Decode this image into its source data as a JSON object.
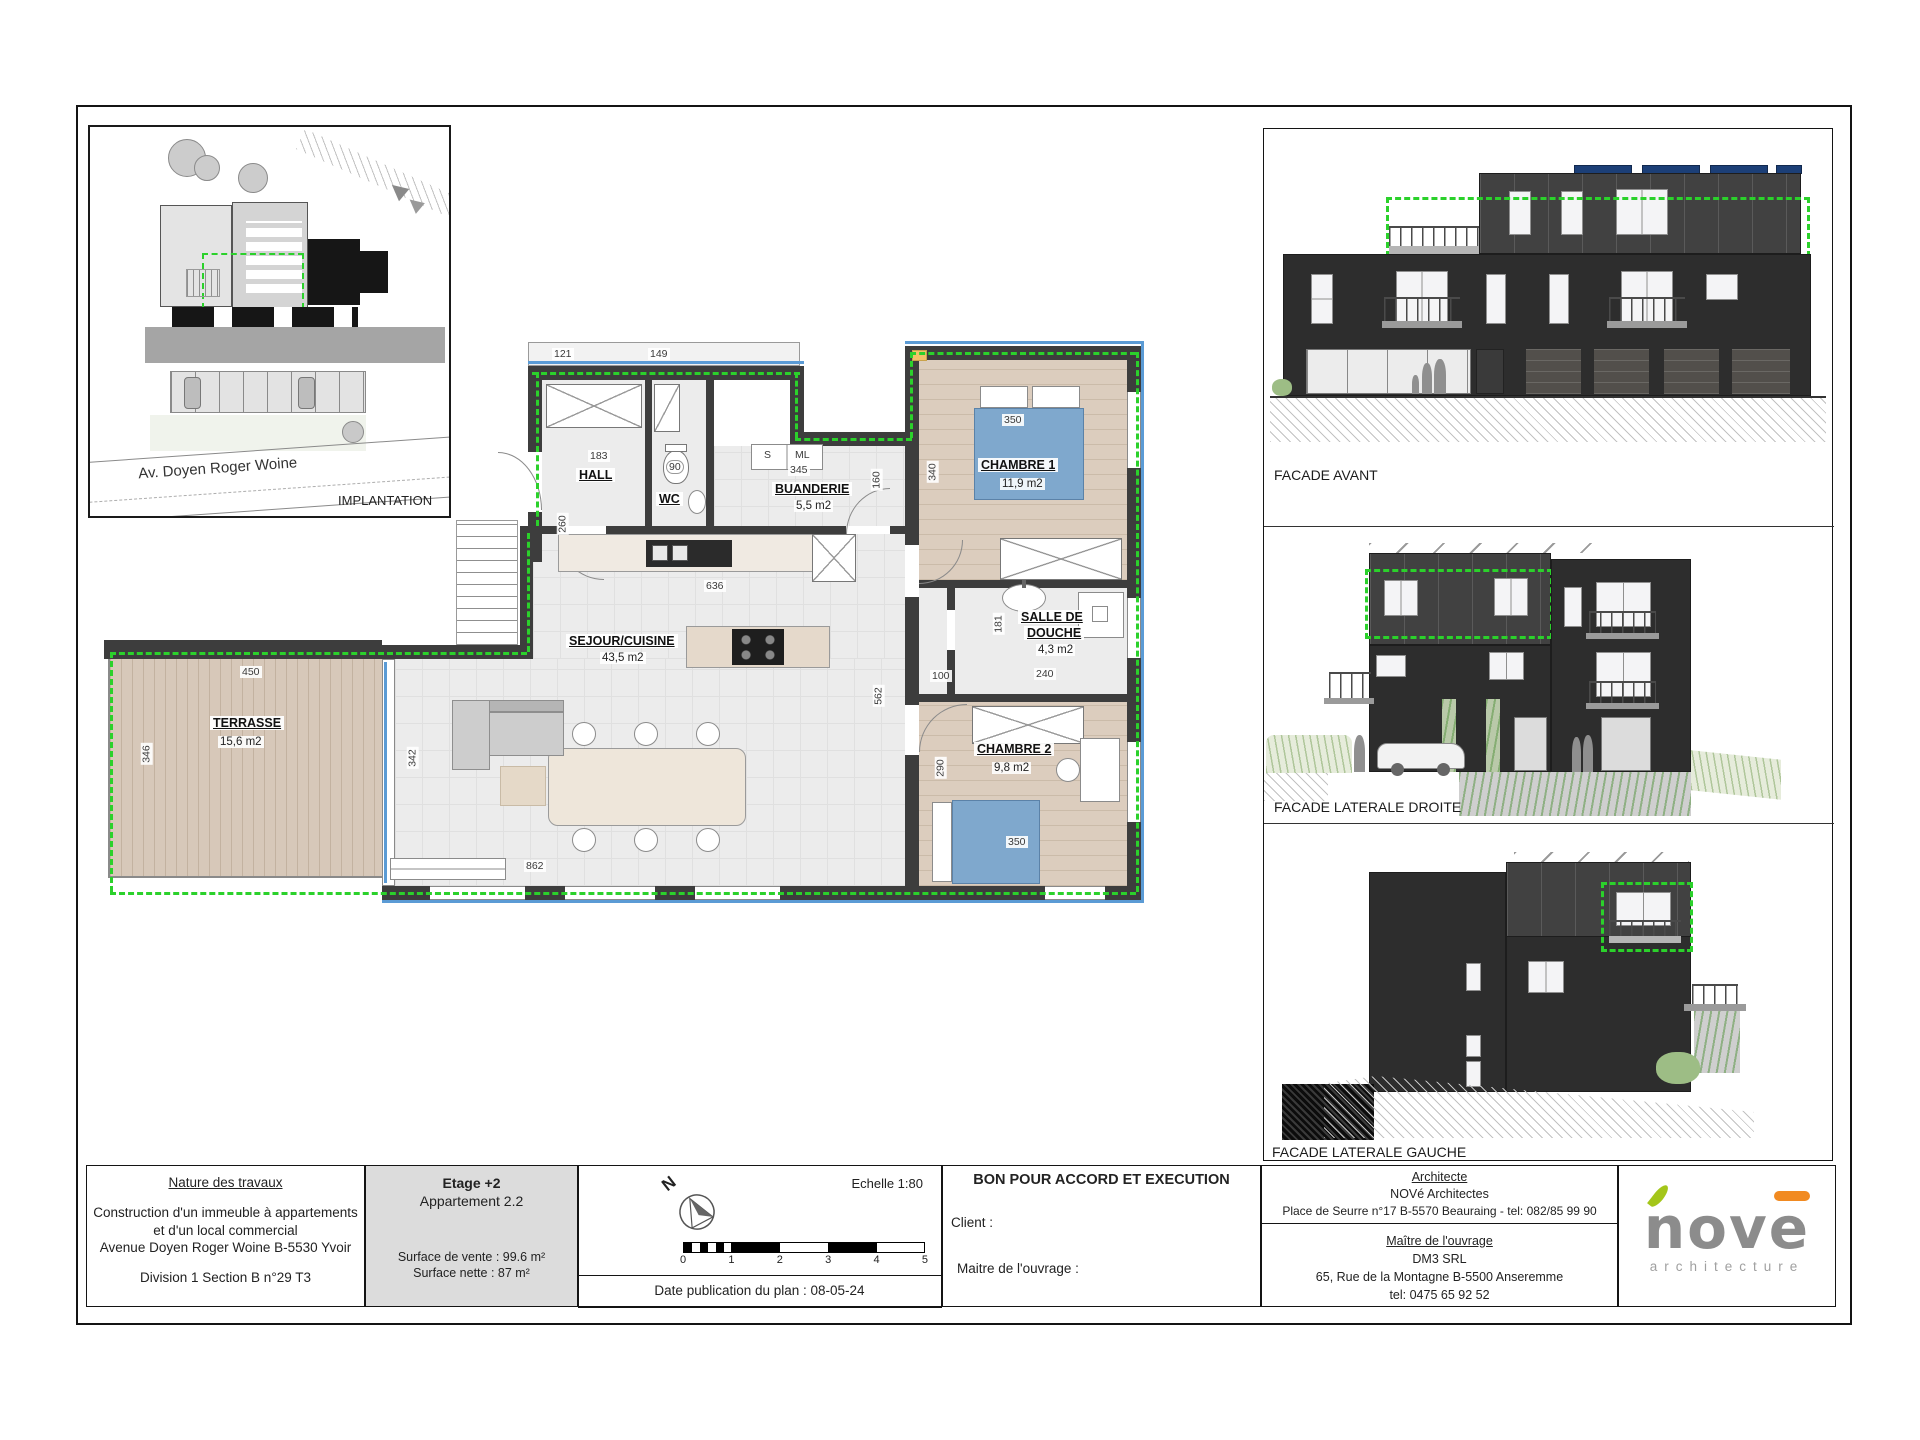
{
  "plan": {
    "rooms": {
      "hall": {
        "name": "HALL"
      },
      "wc": {
        "name": "WC"
      },
      "buanderie": {
        "name": "BUANDERIE",
        "area": "5,5 m2"
      },
      "sejour": {
        "name": "SEJOUR/CUISINE",
        "area": "43,5 m2"
      },
      "terrasse": {
        "name": "TERRASSE",
        "area": "15,6 m2"
      },
      "chambre1": {
        "name": "CHAMBRE 1",
        "area": "11,9 m2"
      },
      "salle_de_douche": {
        "name_line1": "SALLE DE",
        "name_line2": "DOUCHE",
        "area": "4,3 m2"
      },
      "chambre2": {
        "name": "CHAMBRE 2",
        "area": "9,8 m2"
      }
    },
    "appliances": {
      "seche_linge": "S",
      "machine_a_laver": "ML"
    },
    "dims": {
      "landing_a": "121",
      "landing_b": "149",
      "hall_w": "183",
      "hall_h": "260",
      "wc_w": "90",
      "buanderie_w": "345",
      "buanderie_door": "160",
      "ch1_h": "340",
      "ch1_bed_w": "350",
      "kitchen_w": "636",
      "sejour_h": "562",
      "degagement_w": "100",
      "douche_w": "240",
      "douche_h": "181",
      "ch2_h": "290",
      "ch2_bed_w": "350",
      "terrasse_w": "450",
      "terrasse_h": "346",
      "sejour_west_h": "342",
      "sejour_w": "862"
    }
  },
  "implantation": {
    "street": "Av. Doyen Roger Woine",
    "caption": "IMPLANTATION"
  },
  "facades": {
    "avant": "FACADE AVANT",
    "droite": "FACADE LATERALE DROITE",
    "gauche": "FACADE LATERALE GAUCHE"
  },
  "title_block": {
    "nature": {
      "title": "Nature des travaux",
      "line1": "Construction d'un immeuble à appartements",
      "line2": "et d'un local commercial",
      "line3": "Avenue Doyen Roger Woine B-5530 Yvoir",
      "line4": "Division 1 Section B n°29 T3"
    },
    "etage": {
      "title": "Etage +2",
      "apartment": "Appartement 2.2",
      "surface1": "Surface de vente : 99.6 m²",
      "surface2": "Surface nette : 87 m²"
    },
    "scale": {
      "north": "N",
      "echelle": "Echelle 1:80",
      "ticks": [
        "0",
        "1",
        "2",
        "3",
        "4",
        "5"
      ],
      "date": "Date publication du plan : 08-05-24"
    },
    "approval": {
      "title": "BON POUR ACCORD ET EXECUTION",
      "client": "Client :",
      "maitre": "Maitre de l'ouvrage :"
    },
    "architect": {
      "title": "Architecte",
      "name": "NOVé Architectes",
      "address": "Place de Seurre n°17 B-5570 Beauraing - tel: 082/85 99 90",
      "owner_title": "Maître de l'ouvrage",
      "owner_name": "DM3 SRL",
      "owner_address": "65, Rue de la Montagne B-5500 Anseremme",
      "owner_tel": "tel: 0475 65 92 52"
    }
  },
  "logo": {
    "text": "nove",
    "tagline": "architecture"
  },
  "colors": {
    "apartment_outline_green": "#2bd12b",
    "exterior_blue": "#5b9bd5",
    "wall_gray": "#3d3d3d",
    "bed_blue": "#7fa8cd",
    "solar_blue": "#1c3f77",
    "logo_gray": "#8c8c8c",
    "logo_green": "#a4c61a",
    "logo_orange": "#f18a21"
  }
}
